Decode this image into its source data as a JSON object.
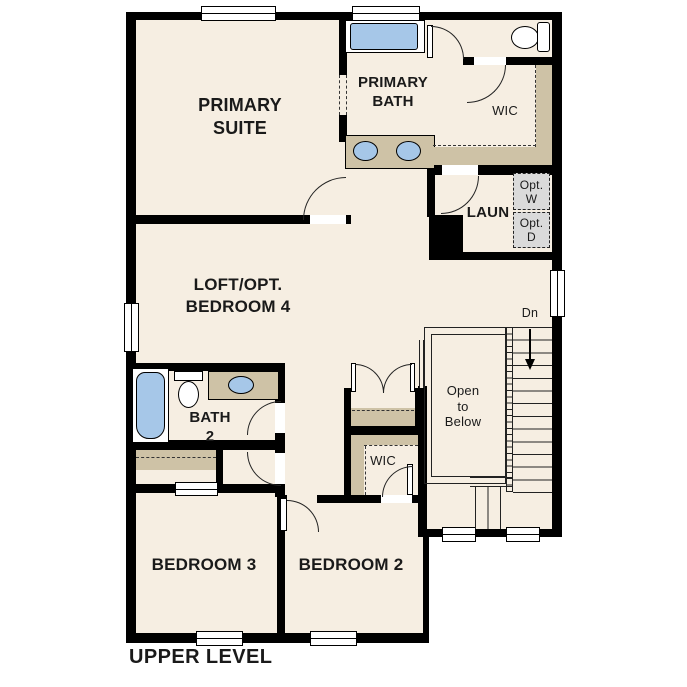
{
  "plan_title": "UPPER LEVEL",
  "colors": {
    "floor": "#f6eee2",
    "wall": "#000000",
    "line": "#222222",
    "counter": "#cec2a6",
    "fixture": "#a6c7e8",
    "appliance": "#dadada",
    "label": "#1a1a1a"
  },
  "rooms": {
    "primary_suite": {
      "label": "PRIMARY\nSUITE"
    },
    "primary_bath": {
      "label": "PRIMARY\nBATH"
    },
    "primary_wic": {
      "label": "WIC"
    },
    "laundry": {
      "label": "LAUN",
      "opt_washer": "Opt.\nW",
      "opt_dryer": "Opt.\nD"
    },
    "loft": {
      "label": "LOFT/OPT.\nBEDROOM 4"
    },
    "bath2": {
      "label": "BATH\n2"
    },
    "bedroom2_wic": {
      "label": "WIC"
    },
    "stairs": {
      "down_label": "Dn"
    },
    "open_to_below": {
      "label": "Open\nto\nBelow"
    },
    "bedroom3": {
      "label": "BEDROOM 3"
    },
    "bedroom2": {
      "label": "BEDROOM 2"
    }
  }
}
